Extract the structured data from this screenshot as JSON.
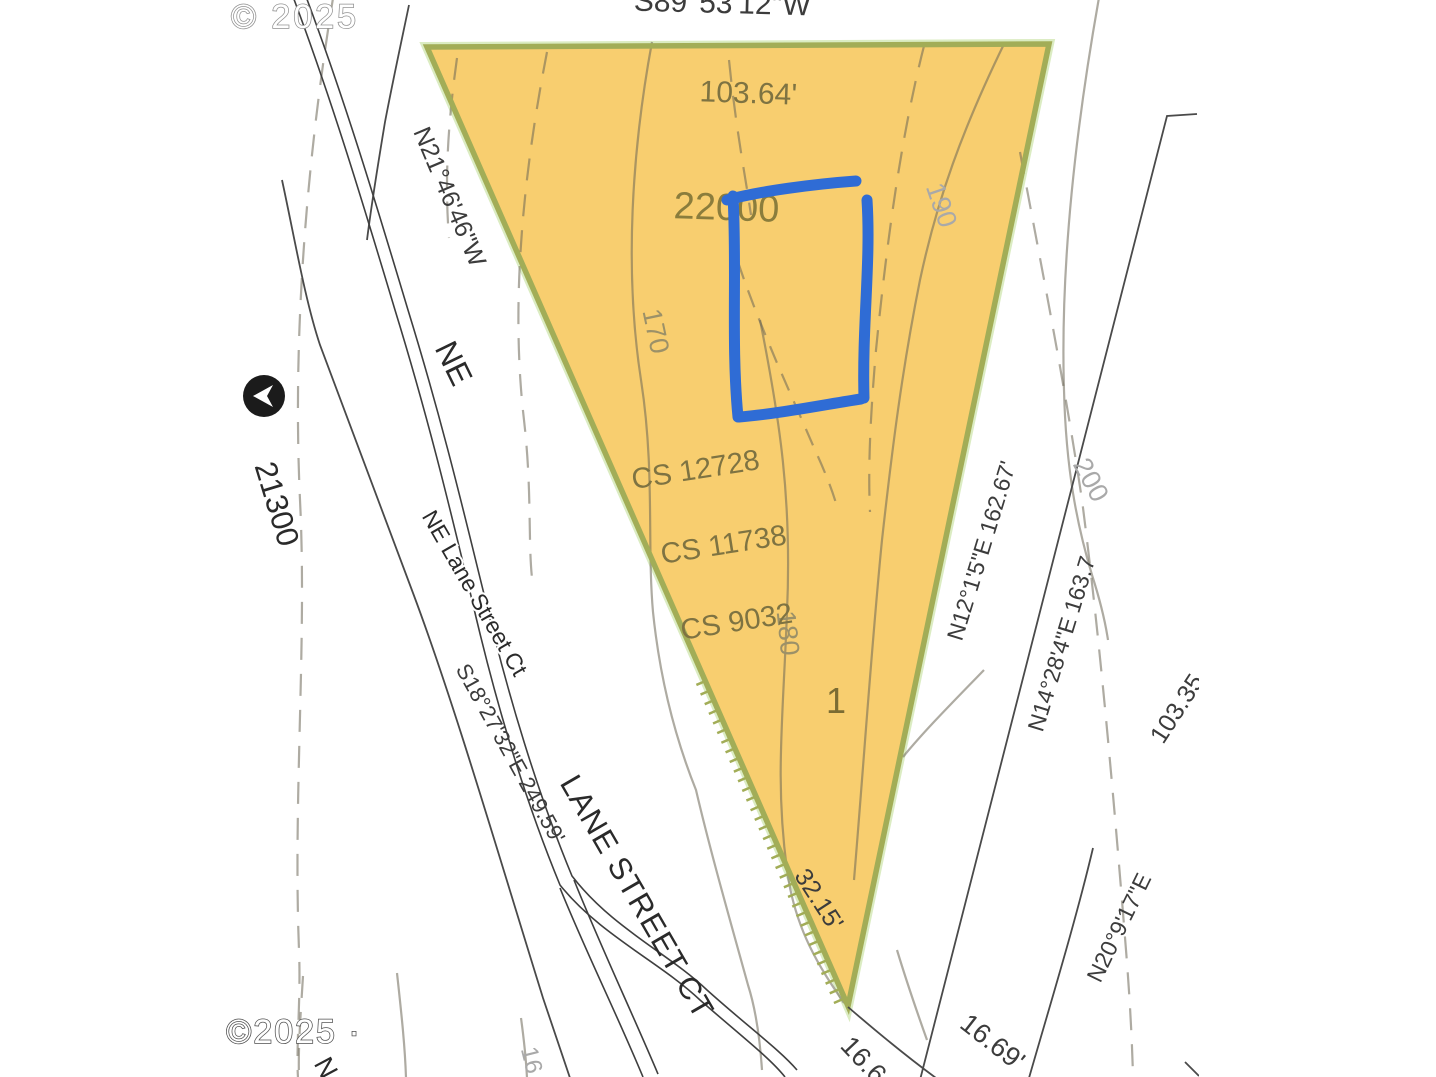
{
  "map": {
    "watermark_top": "© 2025",
    "watermark_bottom": "©2025 ·",
    "parcel": {
      "number": "22000",
      "lot_number": "1",
      "survey_ref_1": "CS 12728",
      "survey_ref_2": "CS 11738",
      "survey_ref_3": "CS 9032",
      "fill_color": "#F8CE6F",
      "border_color": "#A2AD57",
      "glow_color": "#B8DA86"
    },
    "streets": {
      "ne_prefix": "NE",
      "ne_lane_street_ct": "NE Lane Street Ct",
      "lane_street_ct": "LANE STREET CT",
      "address_block": "21300",
      "partial_n": "N"
    },
    "bearings": {
      "top": "S89°53'12\"W",
      "left": "N21°46'46\"W",
      "southwest": "S18°27'32\"E 249.59'",
      "east_1": "N12°1'5\"E 162.67'",
      "east_2": "N14°28'4\"E 163.7",
      "east_3": "N20°9'17\"E"
    },
    "dimensions": {
      "top": "103.64'",
      "bottom": "32.15'",
      "bottom_partial": "16.6",
      "bottom_right": "16.69'",
      "right_partial": "103.35"
    },
    "contour_labels": {
      "c170": "170",
      "c180": "180",
      "c190": "190",
      "c200": "200",
      "c16_partial": "16"
    },
    "annotation": {
      "color": "#2F6CD5"
    }
  }
}
